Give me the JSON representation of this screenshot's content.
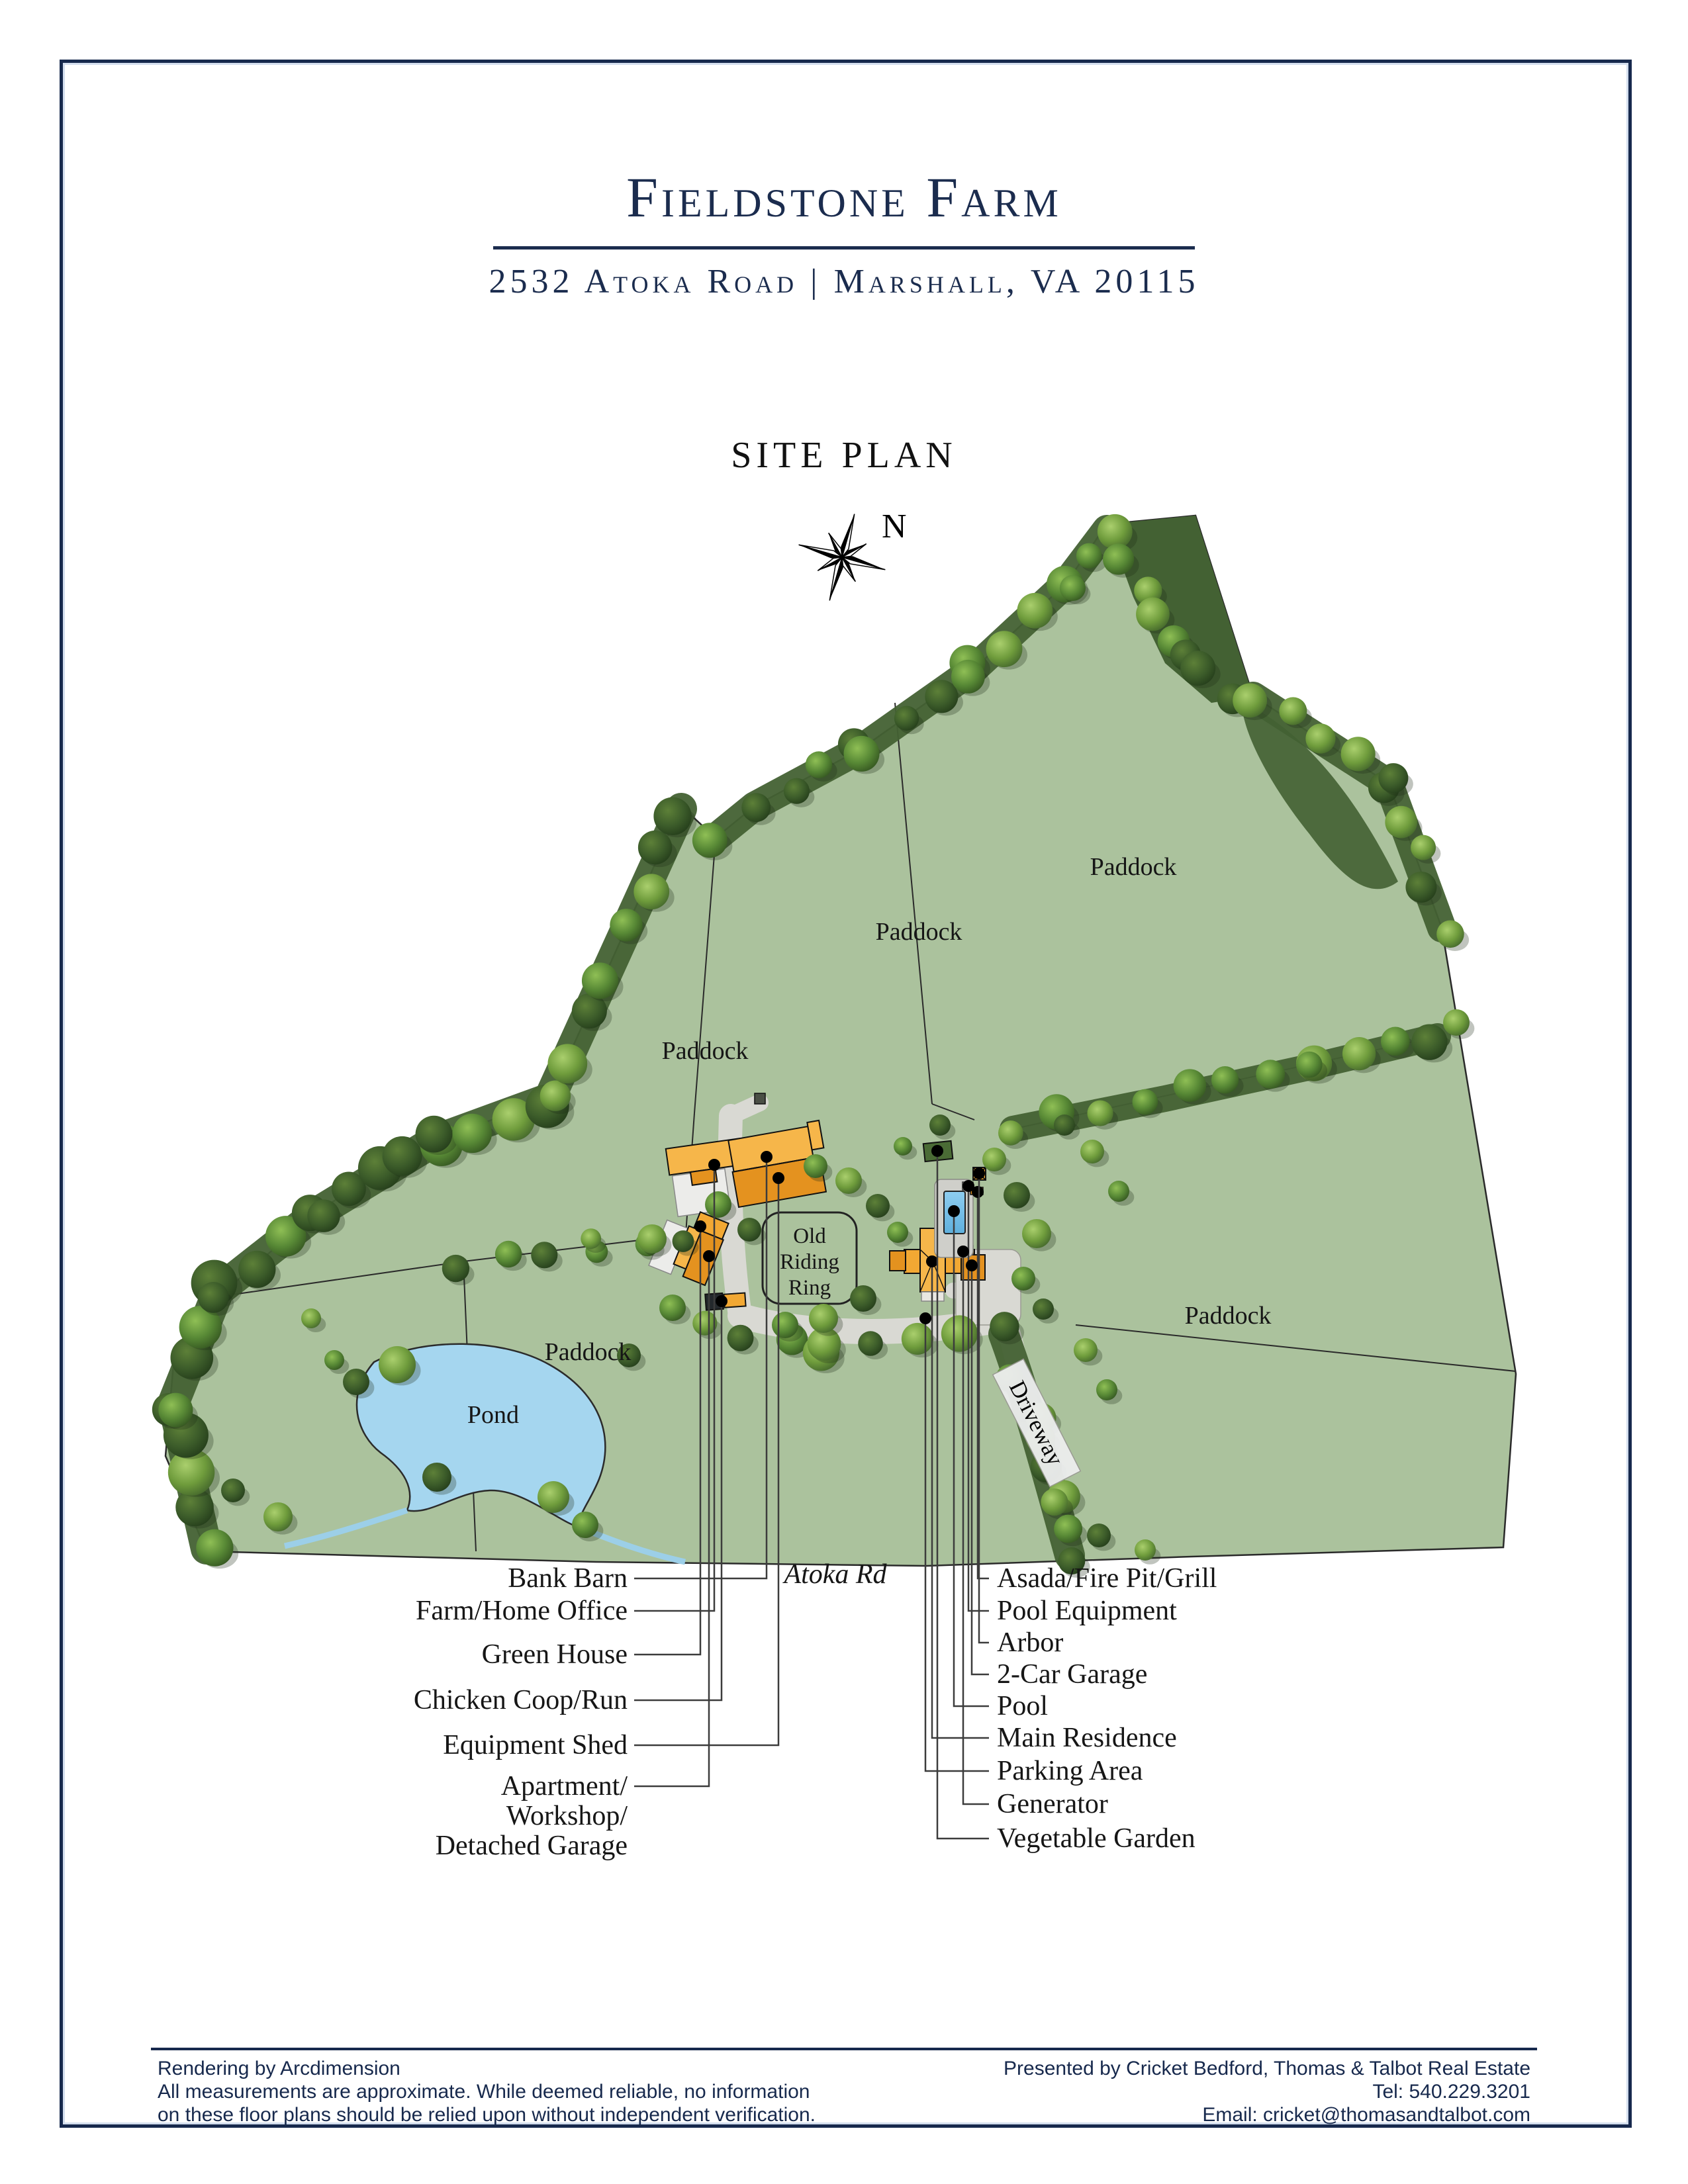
{
  "header": {
    "title": "Fieldstone Farm",
    "subtitle": "2532 Atoka Road | Marshall, VA 20115"
  },
  "plan": {
    "heading": "SITE PLAN",
    "compass_label": "N",
    "labels": {
      "paddock": "Paddock",
      "pond": "Pond",
      "road": "Atoka Rd",
      "driveway": "Driveway",
      "riding_ring": [
        "Old",
        "Riding",
        "Ring"
      ]
    },
    "left_callouts": [
      {
        "lines": [
          "Bank Barn"
        ]
      },
      {
        "lines": [
          "Farm/Home Office"
        ]
      },
      {
        "lines": [
          "Green House"
        ]
      },
      {
        "lines": [
          "Chicken Coop/Run"
        ]
      },
      {
        "lines": [
          "Equipment Shed"
        ]
      },
      {
        "lines": [
          "Apartment/",
          "Workshop/",
          "Detached Garage"
        ]
      }
    ],
    "right_callouts": [
      {
        "lines": [
          "Asada/Fire Pit/Grill"
        ]
      },
      {
        "lines": [
          "Pool Equipment"
        ]
      },
      {
        "lines": [
          "Arbor"
        ]
      },
      {
        "lines": [
          "2-Car Garage"
        ]
      },
      {
        "lines": [
          "Pool"
        ]
      },
      {
        "lines": [
          "Main Residence"
        ]
      },
      {
        "lines": [
          "Parking Area"
        ]
      },
      {
        "lines": [
          "Generator"
        ]
      },
      {
        "lines": [
          "Vegetable Garden"
        ]
      }
    ]
  },
  "footer": {
    "left_lines": [
      "Rendering by Arcdimension",
      "All measurements are approximate. While deemed reliable, no information",
      "on these floor plans should be relied upon without independent verification."
    ],
    "right_lines": [
      "Presented by Cricket Bedford, Thomas & Talbot Real Estate",
      "Tel: 540.229.3201",
      "Email: cricket@thomasandtalbot.com"
    ]
  },
  "colors": {
    "navy": "#1b2c4e",
    "grass": "#abc29d",
    "woods": "#436133",
    "pond": "#a5d6ef",
    "road": "#d9d9d3",
    "building": "#f2a833",
    "building_dark": "#e4921f",
    "ink": "#1a1a1a"
  }
}
